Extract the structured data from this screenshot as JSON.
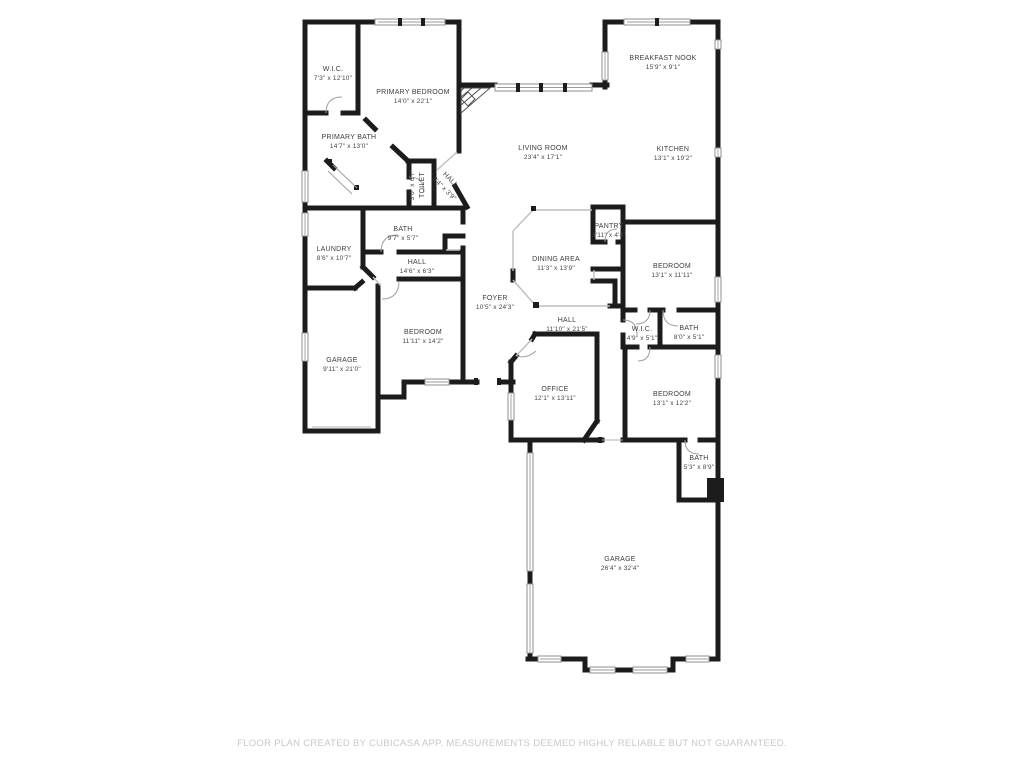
{
  "footer": {
    "disclaimer": "FLOOR PLAN CREATED BY CUBICASA APP. MEASUREMENTS DEEMED HIGHLY RELIABLE BUT NOT GUARANTEED."
  },
  "colors": {
    "wall": "#1c1c1c",
    "room_label": "#3d3d3d",
    "window_outline": "#8f8f8f",
    "opening_line": "#bdbdbd",
    "disclaimer_text": "#c8c8c8",
    "background": "#ffffff"
  },
  "rooms": [
    {
      "name": "W.I.C.",
      "dims": "7'3\" x 12'10\""
    },
    {
      "name": "PRIMARY BEDROOM",
      "dims": "14'0\" x 22'1\""
    },
    {
      "name": "PRIMARY BATH",
      "dims": "14'7\" x 13'0\""
    },
    {
      "name": "TOILET",
      "dims": "3'0\" x 6'7\""
    },
    {
      "name": "HALL",
      "dims": "3'4\" x 3'9\""
    },
    {
      "name": "BREAKFAST NOOK",
      "dims": "15'9\" x 9'1\""
    },
    {
      "name": "KITCHEN",
      "dims": "13'1\" x 19'2\""
    },
    {
      "name": "LIVING ROOM",
      "dims": "23'4\" x 17'1\""
    },
    {
      "name": "BATH",
      "dims": "9'7\" x 5'7\""
    },
    {
      "name": "LAUNDRY",
      "dims": "8'6\" x 10'7\""
    },
    {
      "name": "HALL",
      "dims": "14'6\" x 6'3\""
    },
    {
      "name": "DINING AREA",
      "dims": "11'3\" x 13'9\""
    },
    {
      "name": "PANTRY",
      "dims": "3'11\" x 4'4\""
    },
    {
      "name": "BEDROOM",
      "dims": "13'1\" x 11'11\""
    },
    {
      "name": "FOYER",
      "dims": "10'5\" x 24'3\""
    },
    {
      "name": "HALL",
      "dims": "11'10\" x 21'5\""
    },
    {
      "name": "W.I.C.",
      "dims": "4'9\" x 5'1\""
    },
    {
      "name": "BATH",
      "dims": "8'0\" x 5'1\""
    },
    {
      "name": "BEDROOM",
      "dims": "11'11\" x 14'2\""
    },
    {
      "name": "GARAGE",
      "dims": "9'11\" x 21'0\""
    },
    {
      "name": "OFFICE",
      "dims": "12'1\" x 13'11\""
    },
    {
      "name": "BEDROOM",
      "dims": "13'1\" x 12'2\""
    },
    {
      "name": "BATH",
      "dims": "5'3\" x 8'9\""
    },
    {
      "name": "GARAGE",
      "dims": "26'4\" x 32'4\""
    }
  ]
}
